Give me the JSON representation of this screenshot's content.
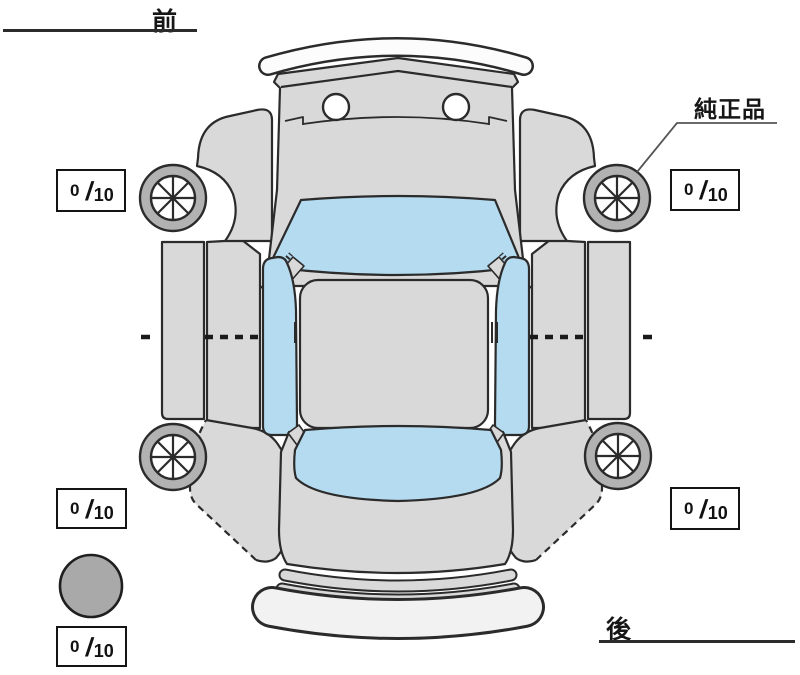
{
  "diagram": {
    "title_hint": "vehicle-top-view-condition-diagram",
    "front_label": "前",
    "rear_label": "後",
    "genuine_part_label": "純正品",
    "tread_boxes": {
      "front_left": {
        "value": "0",
        "slash": "/",
        "max": "10"
      },
      "front_right": {
        "value": "0",
        "slash": "/",
        "max": "10"
      },
      "rear_left": {
        "value": "0",
        "slash": "/",
        "max": "10"
      },
      "rear_right": {
        "value": "0",
        "slash": "/",
        "max": "10"
      },
      "spare": {
        "value": "0",
        "slash": "/",
        "max": "10"
      }
    },
    "colors": {
      "body_fill": "#d9d9d9",
      "glass_fill": "#b4dbef",
      "outline": "#2b2b2b",
      "tire_fill": "#b2b2b2",
      "spare_fill": "#a9a9a9",
      "background": "#ffffff"
    }
  }
}
